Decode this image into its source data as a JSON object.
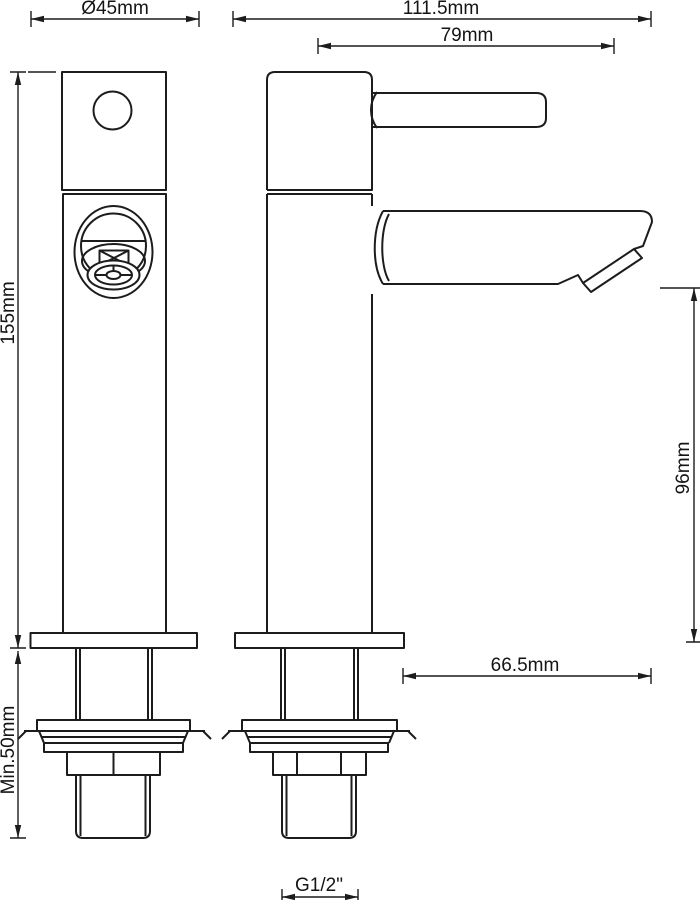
{
  "drawing": {
    "kind": "technical dimension drawing",
    "views": [
      {
        "name": "front elevation"
      },
      {
        "name": "side elevation"
      }
    ]
  },
  "colors": {
    "line": "#1c1c1c",
    "background": "#ffffff"
  },
  "dimensions": {
    "flange_diameter": "Ø45mm",
    "overall_depth": "111.5mm",
    "spout_reach": "79mm",
    "body_height": "155mm",
    "spout_outlet_height": "96mm",
    "spout_overhang": "66.5mm",
    "min_mounting_depth": "Min.50mm",
    "thread_size": "G1/2\""
  }
}
